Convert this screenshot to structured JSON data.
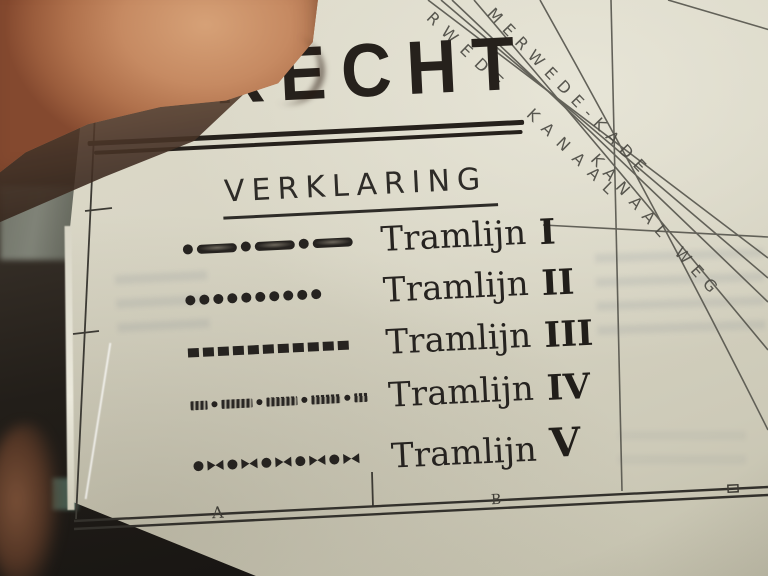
{
  "map": {
    "title": "UTRECHT",
    "legend": {
      "heading": "VERKLARING",
      "items": [
        {
          "name": "Tramlijn",
          "numeral": "I",
          "pattern": "dot-dash"
        },
        {
          "name": "Tramlijn",
          "numeral": "II",
          "pattern": "dots"
        },
        {
          "name": "Tramlijn",
          "numeral": "III",
          "pattern": "square-dashes"
        },
        {
          "name": "Tramlijn",
          "numeral": "IV",
          "pattern": "hatched-dash-dot"
        },
        {
          "name": "Tramlijn",
          "numeral": "V",
          "pattern": "dot-bowtie"
        }
      ]
    },
    "street_labels": {
      "kade": "MERWEDE-KADE",
      "kanaal": "RWEDE  KANAAL",
      "weg": "KANAAL WEG"
    },
    "grid_letters": {
      "a": "A",
      "b": "B"
    },
    "colors": {
      "paper": "#d7d4c3",
      "ink": "#26211c",
      "map_lines": "#55544c"
    }
  }
}
